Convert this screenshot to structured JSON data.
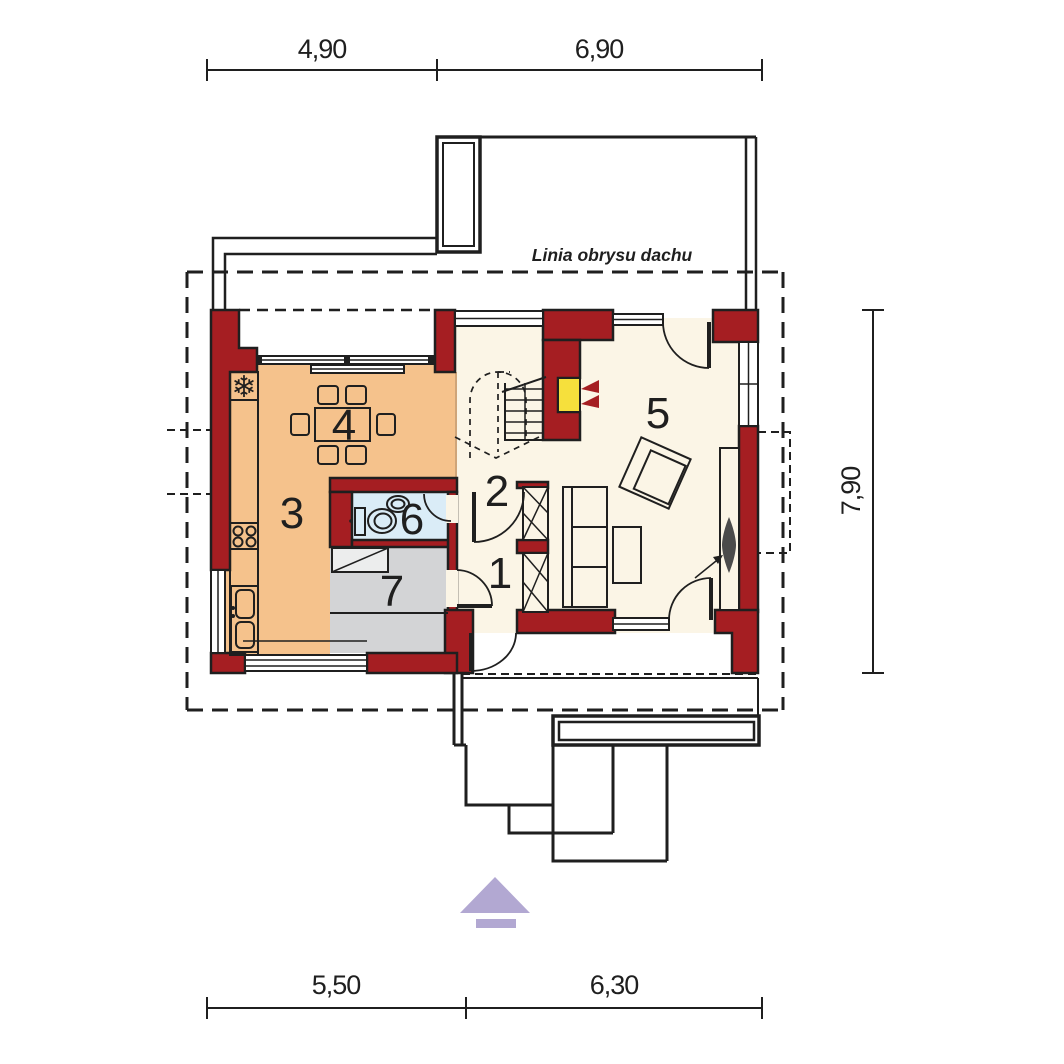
{
  "roof_label": "Linia obrysu dachu",
  "rooms": [
    {
      "number": "1"
    },
    {
      "number": "2"
    },
    {
      "number": "3"
    },
    {
      "number": "4"
    },
    {
      "number": "5"
    },
    {
      "number": "6"
    },
    {
      "number": "7"
    }
  ],
  "dimensions": {
    "top": [
      "4,90",
      "6,90"
    ],
    "bottom": [
      "5,50",
      "6,30"
    ],
    "side": [
      "7,90"
    ]
  },
  "icons": {
    "freezer": "❄"
  },
  "colors": {
    "wall": "#a51e22",
    "line": "#1f1f1f",
    "kitchen_zone": "#f5c28c",
    "bathroom_zone": "#daecf7",
    "storage_zone": "#d3d4d6",
    "floor": "#fbf5e6",
    "fireplace": "#f6e03c",
    "entrance_arrow": "#b2a8d2"
  }
}
